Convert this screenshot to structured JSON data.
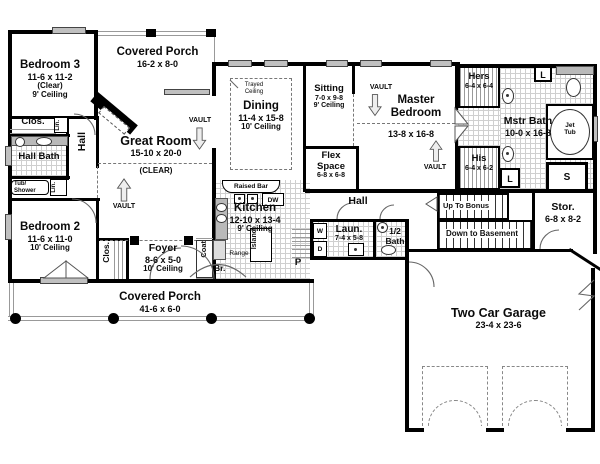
{
  "plan": {
    "title": "House floor plan",
    "rooms": {
      "bedroom3": {
        "name": "Bedroom 3",
        "dims": "11-6 x 11-2",
        "note": "(Clear)",
        "ceiling": "9' Ceiling"
      },
      "covered_porch_top": {
        "name": "Covered Porch",
        "dims": "16-2 x 8-0"
      },
      "great_room": {
        "name": "Great Room",
        "dims": "15-10 x 20-0",
        "note": "(CLEAR)"
      },
      "dining": {
        "name": "Dining",
        "dims": "11-4 x 15-8",
        "ceiling": "10' Ceiling"
      },
      "sitting": {
        "name": "Sitting",
        "dims": "7-0 x 9-8",
        "ceiling": "9' Ceiling"
      },
      "flex_space": {
        "name": "Flex Space",
        "dims": "6-8 x 6-8"
      },
      "master_bedroom": {
        "name": "Master Bedroom",
        "dims": "13-8 x 16-8"
      },
      "hers": {
        "name": "Hers",
        "dims": "6-4 x 6-4"
      },
      "mstr_bath": {
        "name": "Mstr Bath",
        "dims": "10-0 x 16-8"
      },
      "his": {
        "name": "His",
        "dims": "6-4 x 6-2"
      },
      "hall_bath": {
        "name": "Hall Bath"
      },
      "hall_west": {
        "name": "Hall"
      },
      "hall_center": {
        "name": "Hall"
      },
      "bedroom2": {
        "name": "Bedroom 2",
        "dims": "11-6 x 11-0",
        "ceiling": "10' Ceiling"
      },
      "kitchen": {
        "name": "Kitchen",
        "dims": "12-10 x 13-4",
        "ceiling": "9' Ceiling"
      },
      "foyer": {
        "name": "Foyer",
        "dims": "8-6 x 5-0",
        "ceiling": "10' Ceiling"
      },
      "laundry": {
        "name": "Laun.",
        "dims": "7-4 x 5-8"
      },
      "half_bath": {
        "name": "1/2 Bath"
      },
      "storage": {
        "name": "Stor.",
        "dims": "6-8 x 8-2"
      },
      "garage": {
        "name": "Two Car Garage",
        "dims": "23-4 x 23-6"
      },
      "covered_porch_bottom": {
        "name": "Covered Porch",
        "dims": "41-6 x 6-0"
      }
    },
    "fixtures": {
      "closet": "Clos.",
      "linen": "Lin.",
      "linen_short": "L",
      "tub_shower": "Tub/ Shower",
      "coat": "Coat",
      "broom": "Br.",
      "pantry": "P",
      "island": "Island",
      "range": "Range",
      "raised_bar": "Raised Bar",
      "dishwasher": "DW",
      "washer": "W",
      "dryer": "D",
      "jet_tub": "Jet Tub",
      "shower": "S",
      "vault": "VAULT",
      "trayed_ceiling": "Trayed Ceiling",
      "up_to_bonus": "Up To Bonus",
      "down_to_basement": "Down to Basement"
    },
    "colors": {
      "wall": "#000000",
      "window": "#c0c0c0",
      "tile_line": "#cfcfcf",
      "dash": "#777777",
      "paper": "#ffffff"
    }
  }
}
